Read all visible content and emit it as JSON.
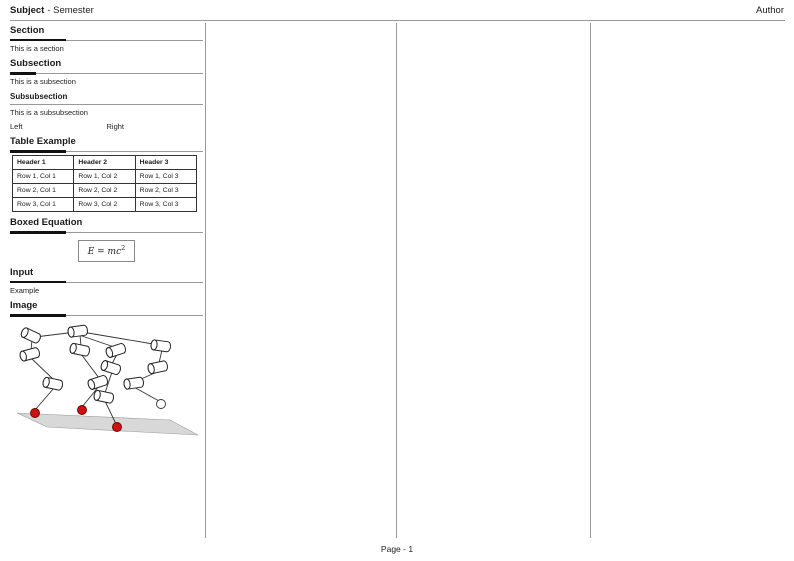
{
  "header": {
    "subject": "Subject",
    "title_rest": "- Semester",
    "author": "Author"
  },
  "footer": {
    "page_label": "Page - 1"
  },
  "column1": {
    "section": {
      "title": "Section",
      "body": "This is a section"
    },
    "subsection": {
      "title": "Subsection",
      "body": "This is a subsection"
    },
    "subsubsection": {
      "title": "Subsubsection",
      "body": "This is a subsubsection"
    },
    "two_col": {
      "left": "Left",
      "right": "Right"
    },
    "table_example": {
      "title": "Table Example",
      "headers": [
        "Header 1",
        "Header 2",
        "Header 3"
      ],
      "rows": [
        [
          "Row 1, Col 1",
          "Row 1, Col 2",
          "Row 1, Col 3"
        ],
        [
          "Row 2, Col 1",
          "Row 2, Col 2",
          "Row 2, Col 3"
        ],
        [
          "Row 3, Col 1",
          "Row 3, Col 2",
          "Row 3, Col 3"
        ]
      ]
    },
    "boxed_equation": {
      "title": "Boxed Equation",
      "equation_base": "E = mc",
      "equation_sup": "2"
    },
    "input": {
      "title": "Input",
      "body": "Example"
    },
    "image": {
      "title": "Image"
    }
  },
  "colors": {
    "rule_gray": "#999999",
    "accent_black": "#111111",
    "foot_red": "#cc1111",
    "ground_gray": "#d8d8d8"
  }
}
